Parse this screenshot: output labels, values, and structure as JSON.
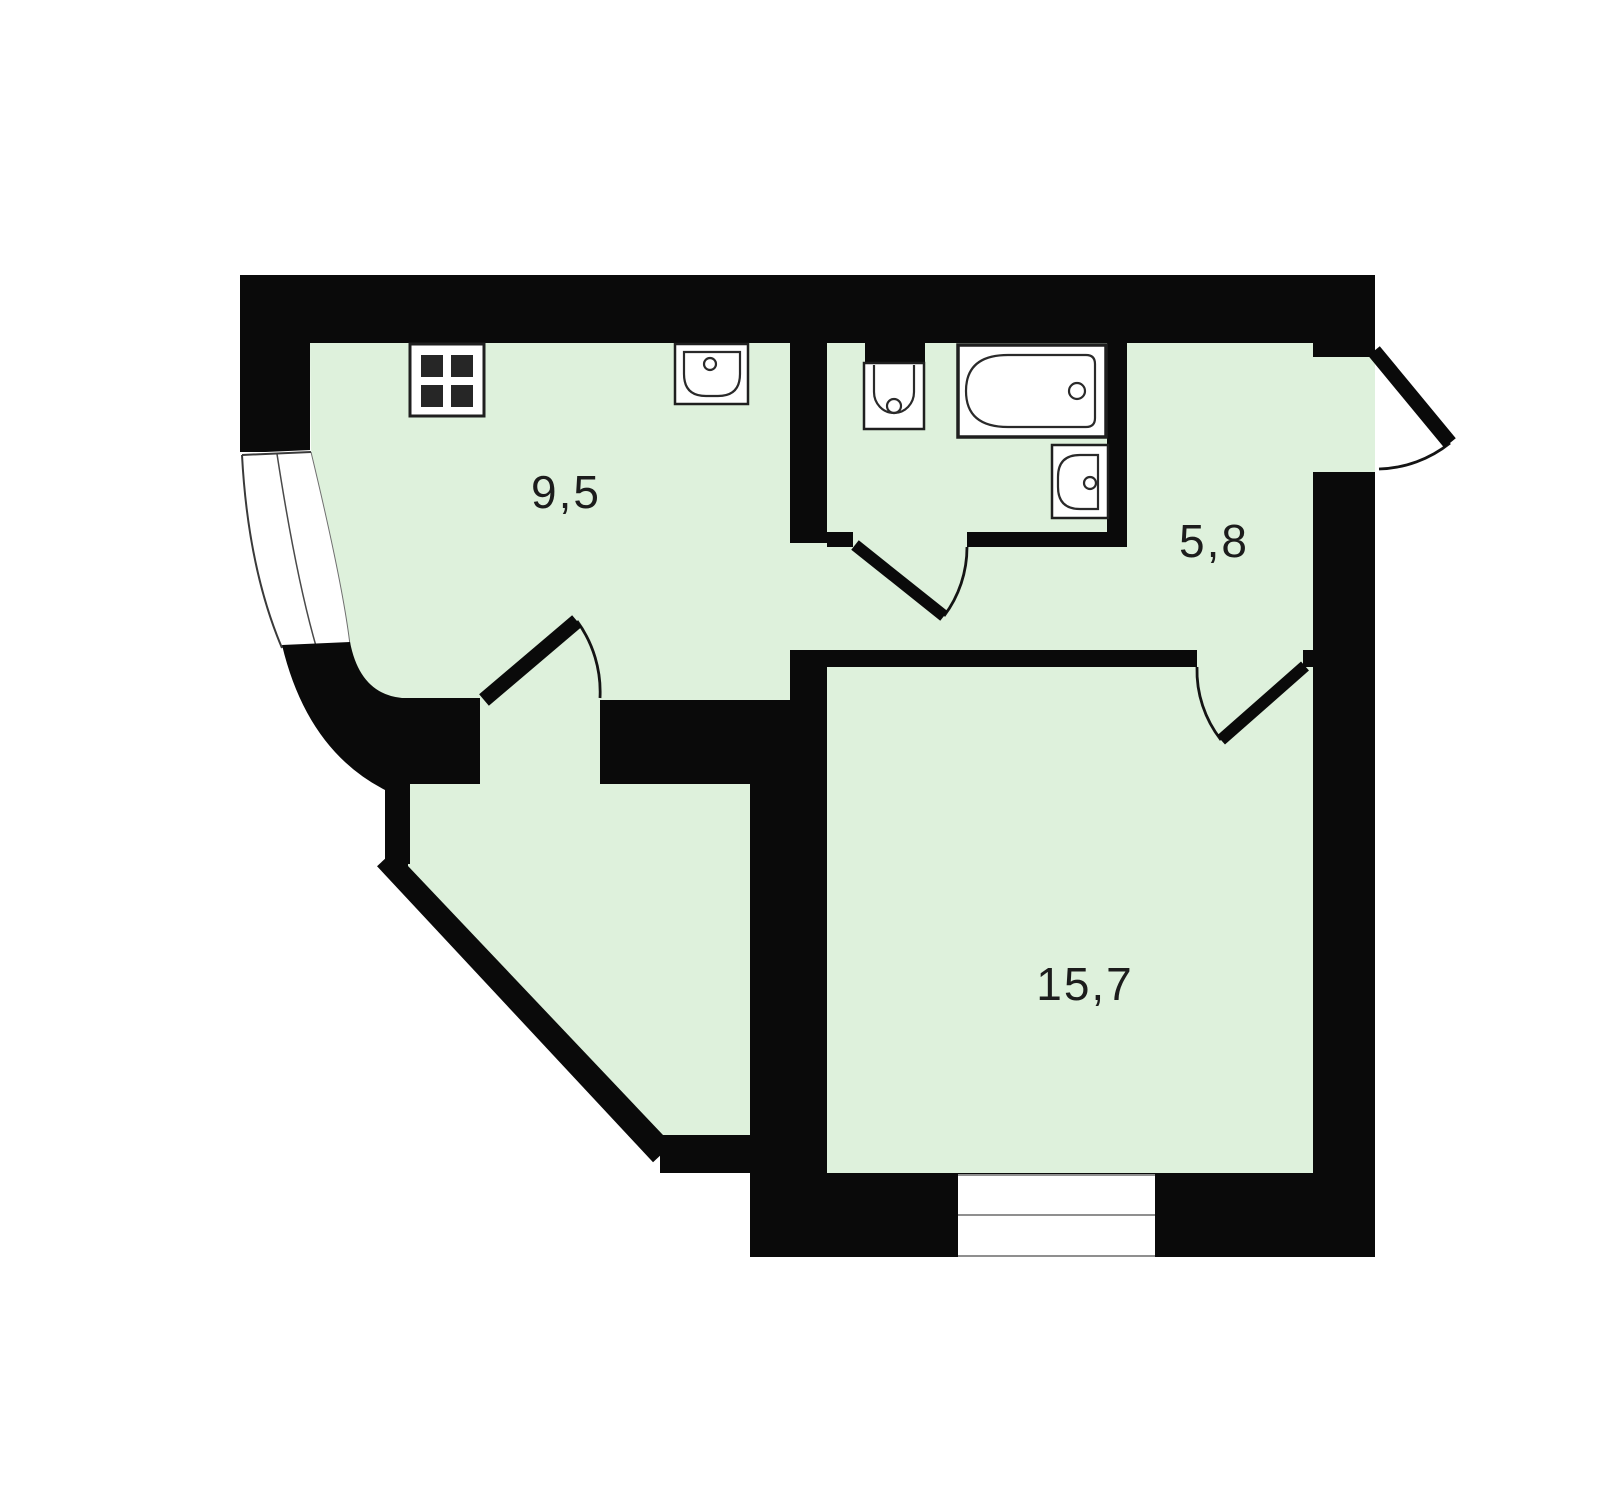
{
  "title": "Apartment floor plan",
  "colors": {
    "background": "#ffffff",
    "walls": "#0a0a0a",
    "room_fill": "#def1dc",
    "fixture_outline": "#1f1f1f",
    "window_line": "#8f8f8f",
    "label_text": "#1c1c1c"
  },
  "rooms": [
    {
      "name": "kitchen",
      "area": "9,5"
    },
    {
      "name": "hallway",
      "area": "5,8"
    },
    {
      "name": "living-room",
      "area": "15,7"
    }
  ],
  "fixtures": [
    {
      "name": "stove"
    },
    {
      "name": "kitchen-sink"
    },
    {
      "name": "toilet"
    },
    {
      "name": "bathtub"
    },
    {
      "name": "bathroom-sink"
    }
  ],
  "windows": [
    {
      "name": "bay-window"
    },
    {
      "name": "living-room-window"
    }
  ],
  "doors": [
    {
      "name": "kitchen-door"
    },
    {
      "name": "bathroom-door"
    },
    {
      "name": "living-room-door"
    },
    {
      "name": "entrance-door"
    }
  ]
}
